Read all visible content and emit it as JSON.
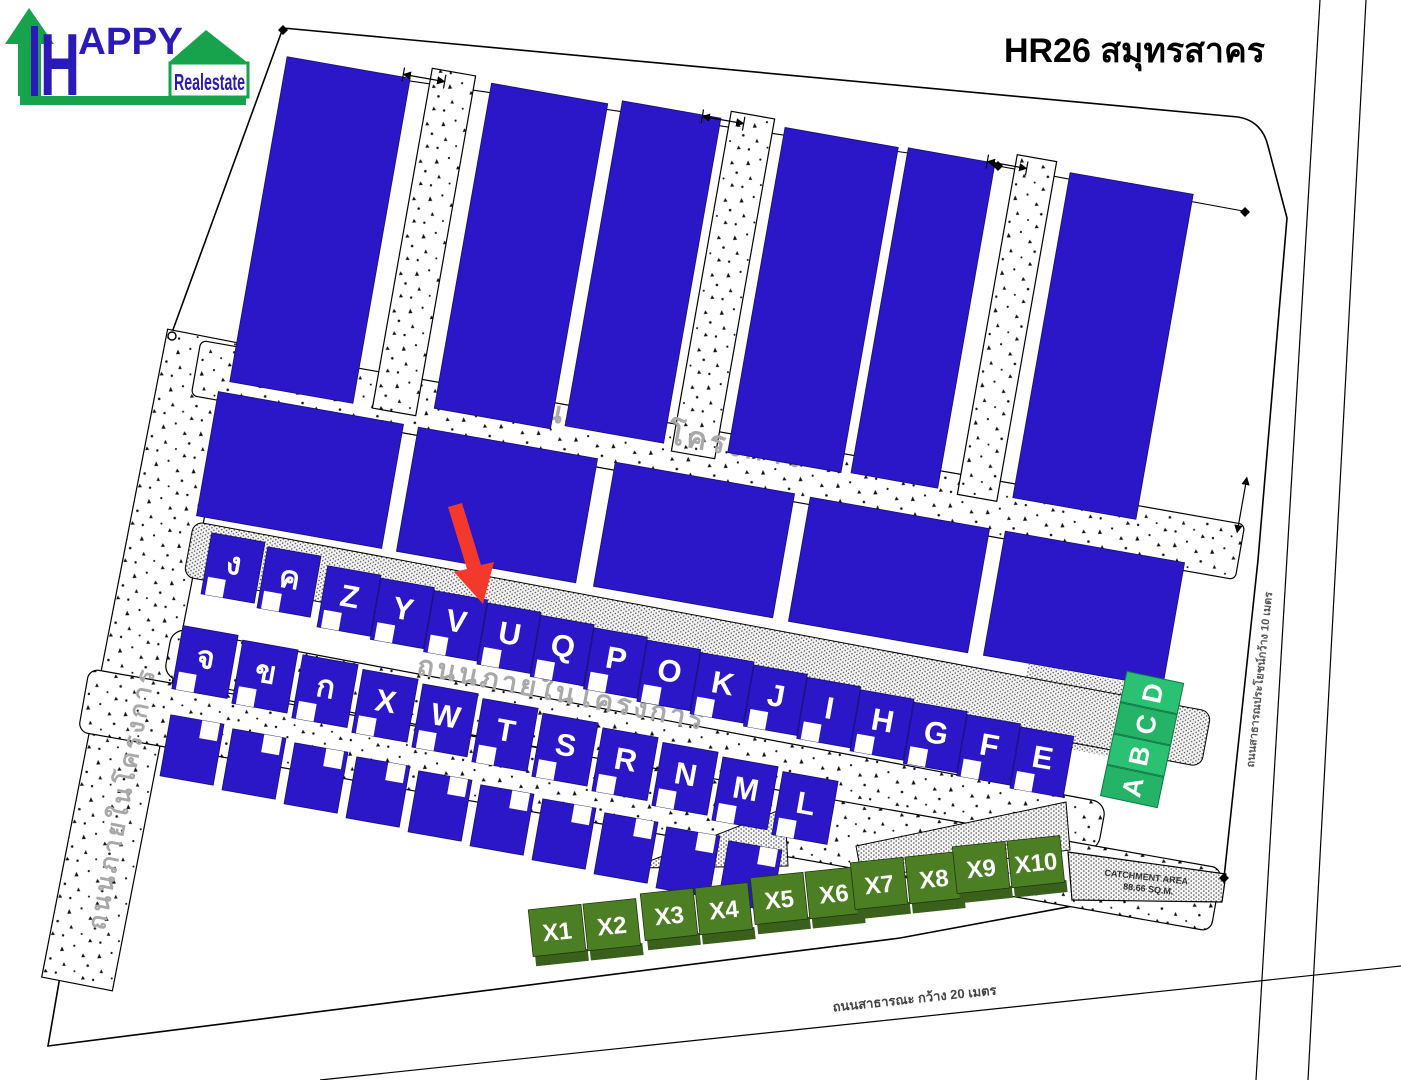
{
  "title": "HR26 สมุทรสาคร",
  "logo": {
    "h": "H",
    "appy": "APPY",
    "realestate": "Realestate"
  },
  "roads": {
    "internal": "ถนนภายในโครงการ",
    "right_public": "ถนนสาธารณประโยชน์กว้าง 10 เมตร",
    "bottom_public": "ถนนสาธารณะ กว้าง 20 เมตร"
  },
  "catchment": {
    "line1": "CATCHMENT AREA",
    "line2": "88.66 SQ.M."
  },
  "plots": {
    "row_top": [
      "ง",
      "ค",
      "Z",
      "Y",
      "V",
      "U",
      "Q",
      "P",
      "O",
      "K",
      "J",
      "I",
      "H",
      "G",
      "F",
      "E"
    ],
    "row_mid": [
      "จ",
      "ข",
      "ก",
      "X",
      "W",
      "T",
      "S",
      "R",
      "N",
      "M",
      "L"
    ],
    "green_strip": [
      "A",
      "B",
      "C",
      "D"
    ],
    "row_x": [
      "X1",
      "X2",
      "X3",
      "X4",
      "X5",
      "X6",
      "X7",
      "X8",
      "X9",
      "X10"
    ]
  },
  "annotations": {
    "arrow_points_to": "V"
  },
  "colors": {
    "plot_blue": "#2b16c8",
    "green_strip": "#2bc173",
    "green_strip_alt": "#25b367",
    "green_x": "#4c7e23",
    "green_x_dark": "#3a611b",
    "logo_green": "#17a34b",
    "logo_blue": "#2a1ab9",
    "arrow_red": "#f4392c",
    "road_label": "#a9a9a9"
  }
}
